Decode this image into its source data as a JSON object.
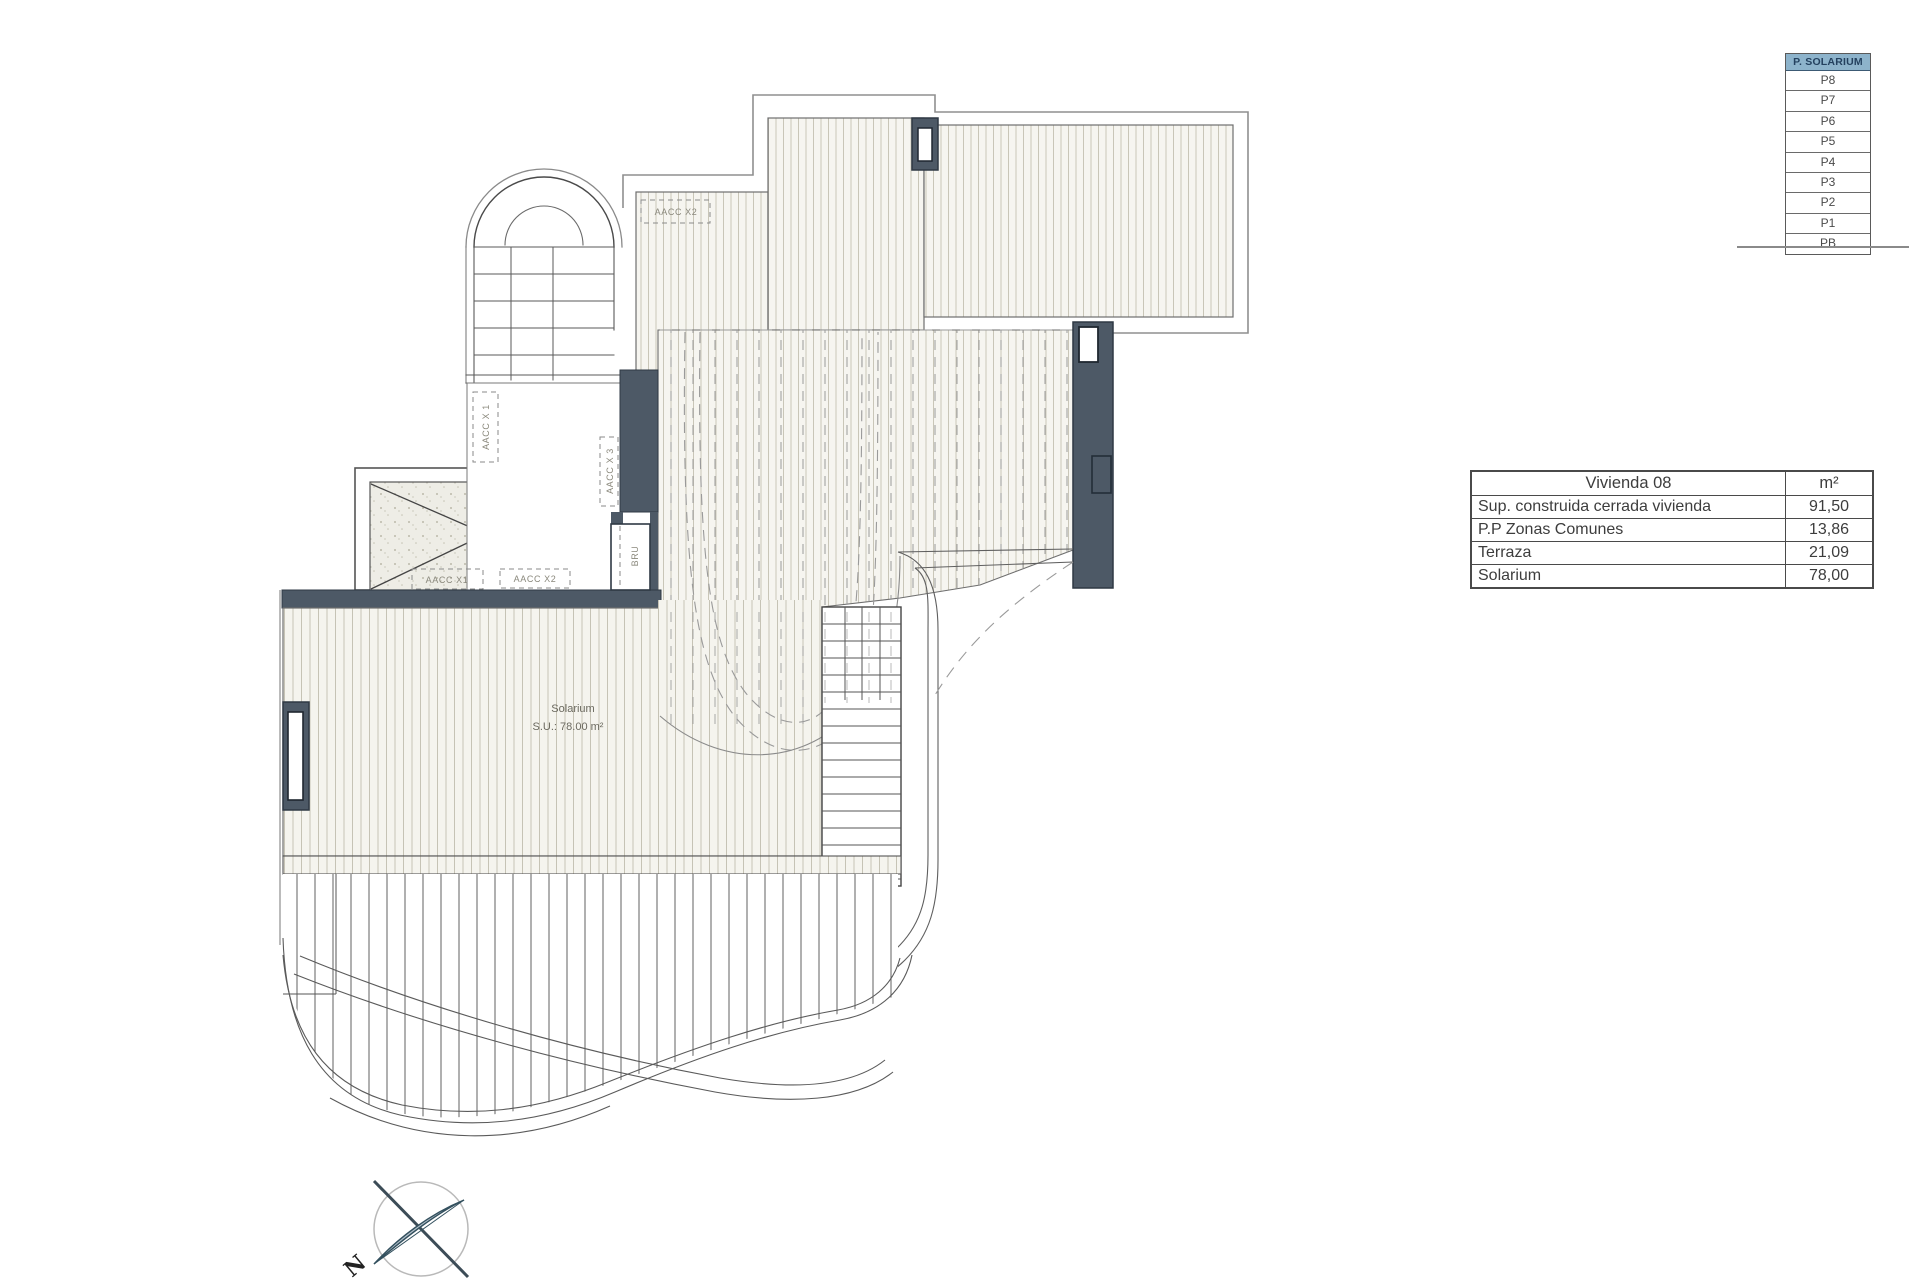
{
  "legend": {
    "header": "P. SOLARIUM",
    "floors": [
      "P8",
      "P7",
      "P6",
      "P5",
      "P4",
      "P3",
      "P2",
      "P1",
      "PB"
    ],
    "header_bg": "#8db3cb",
    "header_text_color": "#24415f"
  },
  "area_table": {
    "title": "Vivienda 08",
    "unit_header": "m²",
    "rows": [
      {
        "label": "Sup. construida cerrada vivienda",
        "value": "91,50"
      },
      {
        "label": "P.P Zonas Comunes",
        "value": "13,86"
      },
      {
        "label": "Terraza",
        "value": "21,09"
      },
      {
        "label": "Solarium",
        "value": "78,00"
      }
    ]
  },
  "plan": {
    "solarium_label": "Solarium",
    "solarium_area": "S.U.: 78.00 m²",
    "labels": {
      "aacc_x2_top": "AACC X2",
      "aacc_x1_left": "AACC X 1",
      "aacc_x3_right": "AACC X 3",
      "bru": "BRU",
      "aacc_x1_bottom": "AACC X1",
      "aacc_x2_bottom": "AACC X2"
    },
    "north_label": "N"
  },
  "colors": {
    "wall_dark": "#4d5966",
    "hatch_line": "#ccc9bb",
    "hatch_bg": "#f6f5f0",
    "outline": "#6e6e6e",
    "dashed": "#9a9a9a",
    "compass_needle": "#b5c2cc"
  }
}
